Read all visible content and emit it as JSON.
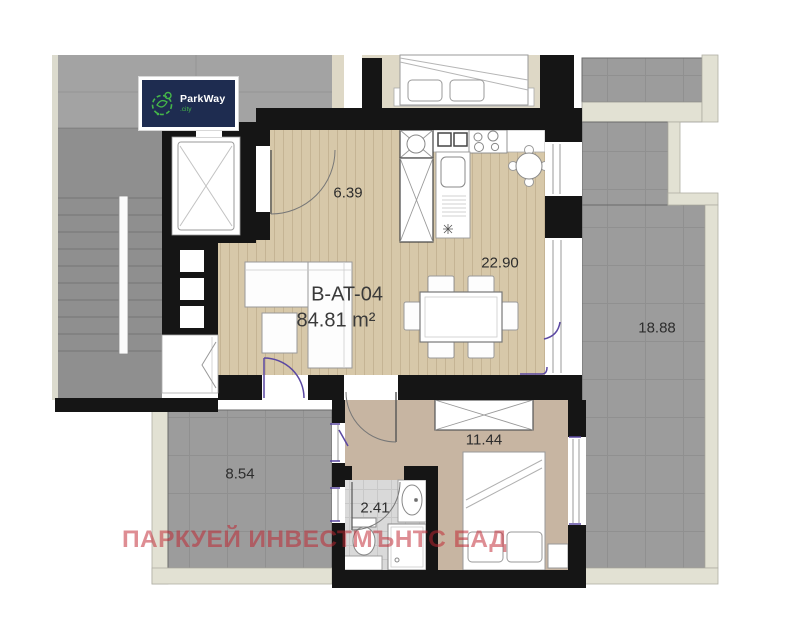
{
  "plan": {
    "unit_id": "B-AT-04",
    "unit_area": "84.81 m²",
    "rooms": [
      {
        "name": "hallway",
        "area": "6.39"
      },
      {
        "name": "living-dining",
        "area": "22.90"
      },
      {
        "name": "terrace-right",
        "area": "18.88"
      },
      {
        "name": "terrace-left",
        "area": "8.54"
      },
      {
        "name": "bedroom",
        "area": "11.44"
      },
      {
        "name": "bathroom",
        "area": "2.41"
      }
    ]
  },
  "logo": {
    "brand": "ParkWay",
    "suffix": ".city"
  },
  "watermark": {
    "text": "ПАРКУЕЙ ИНВЕСТМЪНТС ЕАД"
  },
  "colors": {
    "wall": "#151515",
    "wood_floor": "#d7c8a9",
    "bedroom_floor": "#c7b5a2",
    "terrace_gray": "#9c9c9c",
    "stair_gray": "#8f8f8f",
    "parapet_light": "#e2e1d3",
    "bathroom_tile": "#d9d9d9",
    "door_mark_purple": "#5b48a2",
    "watermark_red": "#c02430",
    "logo_navy": "#1e2c50",
    "logo_green": "#45b649"
  }
}
